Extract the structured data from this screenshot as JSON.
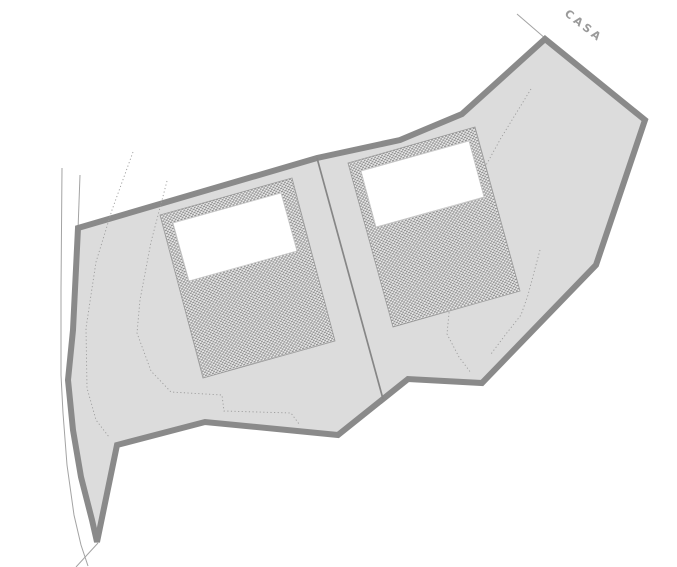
{
  "drawing": {
    "label_casa": "CASA",
    "label_transform": {
      "x": 570,
      "y": 7,
      "angle": 38
    },
    "colors": {
      "background": "#ffffff",
      "parcel_fill": "#dcdcdc",
      "boundary_stroke": "#8a8a8a",
      "division_line": "#868686",
      "hatch_dark": "#929292",
      "hatch_light": "#eaeaea",
      "pad_outline": "#9a9a9a",
      "building_fill": "#ffffff",
      "building_outline": "#c6c6c6",
      "thin_line": "#a3a3a3",
      "contour_dotted": "#9c9c9c",
      "label_color": "#9a9a9a"
    },
    "geometry": {
      "parcel_boundary": [
        [
          78,
          228
        ],
        [
          317,
          158
        ],
        [
          400,
          140
        ],
        [
          462,
          114
        ],
        [
          545,
          39
        ],
        [
          645,
          120
        ],
        [
          596,
          265
        ],
        [
          482,
          383
        ],
        [
          408,
          379
        ],
        [
          338,
          435
        ],
        [
          205,
          422
        ],
        [
          117,
          445
        ],
        [
          97,
          542
        ],
        [
          92,
          520
        ],
        [
          81,
          477
        ],
        [
          73,
          430
        ],
        [
          68,
          380
        ],
        [
          73,
          330
        ]
      ],
      "boundary_stroke_width": 6,
      "division_line": [
        [
          317,
          158
        ],
        [
          383,
          399
        ]
      ],
      "pads": [
        {
          "points": [
            [
              160,
              215
            ],
            [
              292,
              178
            ],
            [
              335,
              341
            ],
            [
              203,
              378
            ]
          ]
        },
        {
          "points": [
            [
              348,
              163
            ],
            [
              475,
              127
            ],
            [
              520,
              291
            ],
            [
              393,
              327
            ]
          ]
        }
      ],
      "buildings": [
        {
          "points": [
            [
              173,
              223
            ],
            [
              281,
              193
            ],
            [
              297,
              251
            ],
            [
              189,
              281
            ]
          ]
        },
        {
          "points": [
            [
              361,
              171
            ],
            [
              469,
              141
            ],
            [
              484,
              197
            ],
            [
              376,
              227
            ]
          ]
        }
      ],
      "thin_lines": [
        {
          "name": "road-edge-line",
          "points": [
            [
              62,
              168
            ],
            [
              61,
              290
            ],
            [
              61,
              375
            ],
            [
              63,
              413
            ],
            [
              67,
              465
            ],
            [
              74,
              515
            ],
            [
              81,
              545
            ],
            [
              88,
              566
            ]
          ]
        },
        {
          "name": "boundary-extension-line-top-left",
          "points": [
            [
              80,
              175
            ],
            [
              78,
              230
            ]
          ]
        },
        {
          "name": "casa-leader-line",
          "points": [
            [
              517,
              14
            ],
            [
              546,
              39
            ]
          ]
        },
        {
          "name": "boundary-extension-line-bottom",
          "points": [
            [
              98,
              543
            ],
            [
              76,
              567
            ]
          ]
        }
      ],
      "dotted_contours": [
        [
          [
            133,
            152
          ],
          [
            112,
            210
          ],
          [
            96,
            262
          ],
          [
            86,
            328
          ],
          [
            87,
            388
          ],
          [
            96,
            420
          ],
          [
            109,
            437
          ]
        ],
        [
          [
            167,
            181
          ],
          [
            151,
            242
          ],
          [
            140,
            300
          ],
          [
            137,
            333
          ],
          [
            151,
            371
          ],
          [
            171,
            392
          ],
          [
            222,
            395
          ],
          [
            224,
            411
          ],
          [
            291,
            413
          ],
          [
            299,
            424
          ]
        ],
        [
          [
            531,
            89
          ],
          [
            501,
            138
          ],
          [
            485,
            167
          ],
          [
            464,
            218
          ],
          [
            452,
            282
          ],
          [
            447,
            334
          ],
          [
            459,
            357
          ],
          [
            471,
            373
          ]
        ],
        [
          [
            540,
            250
          ],
          [
            528,
            295
          ],
          [
            521,
            315
          ],
          [
            506,
            334
          ],
          [
            491,
            354
          ]
        ]
      ]
    }
  }
}
